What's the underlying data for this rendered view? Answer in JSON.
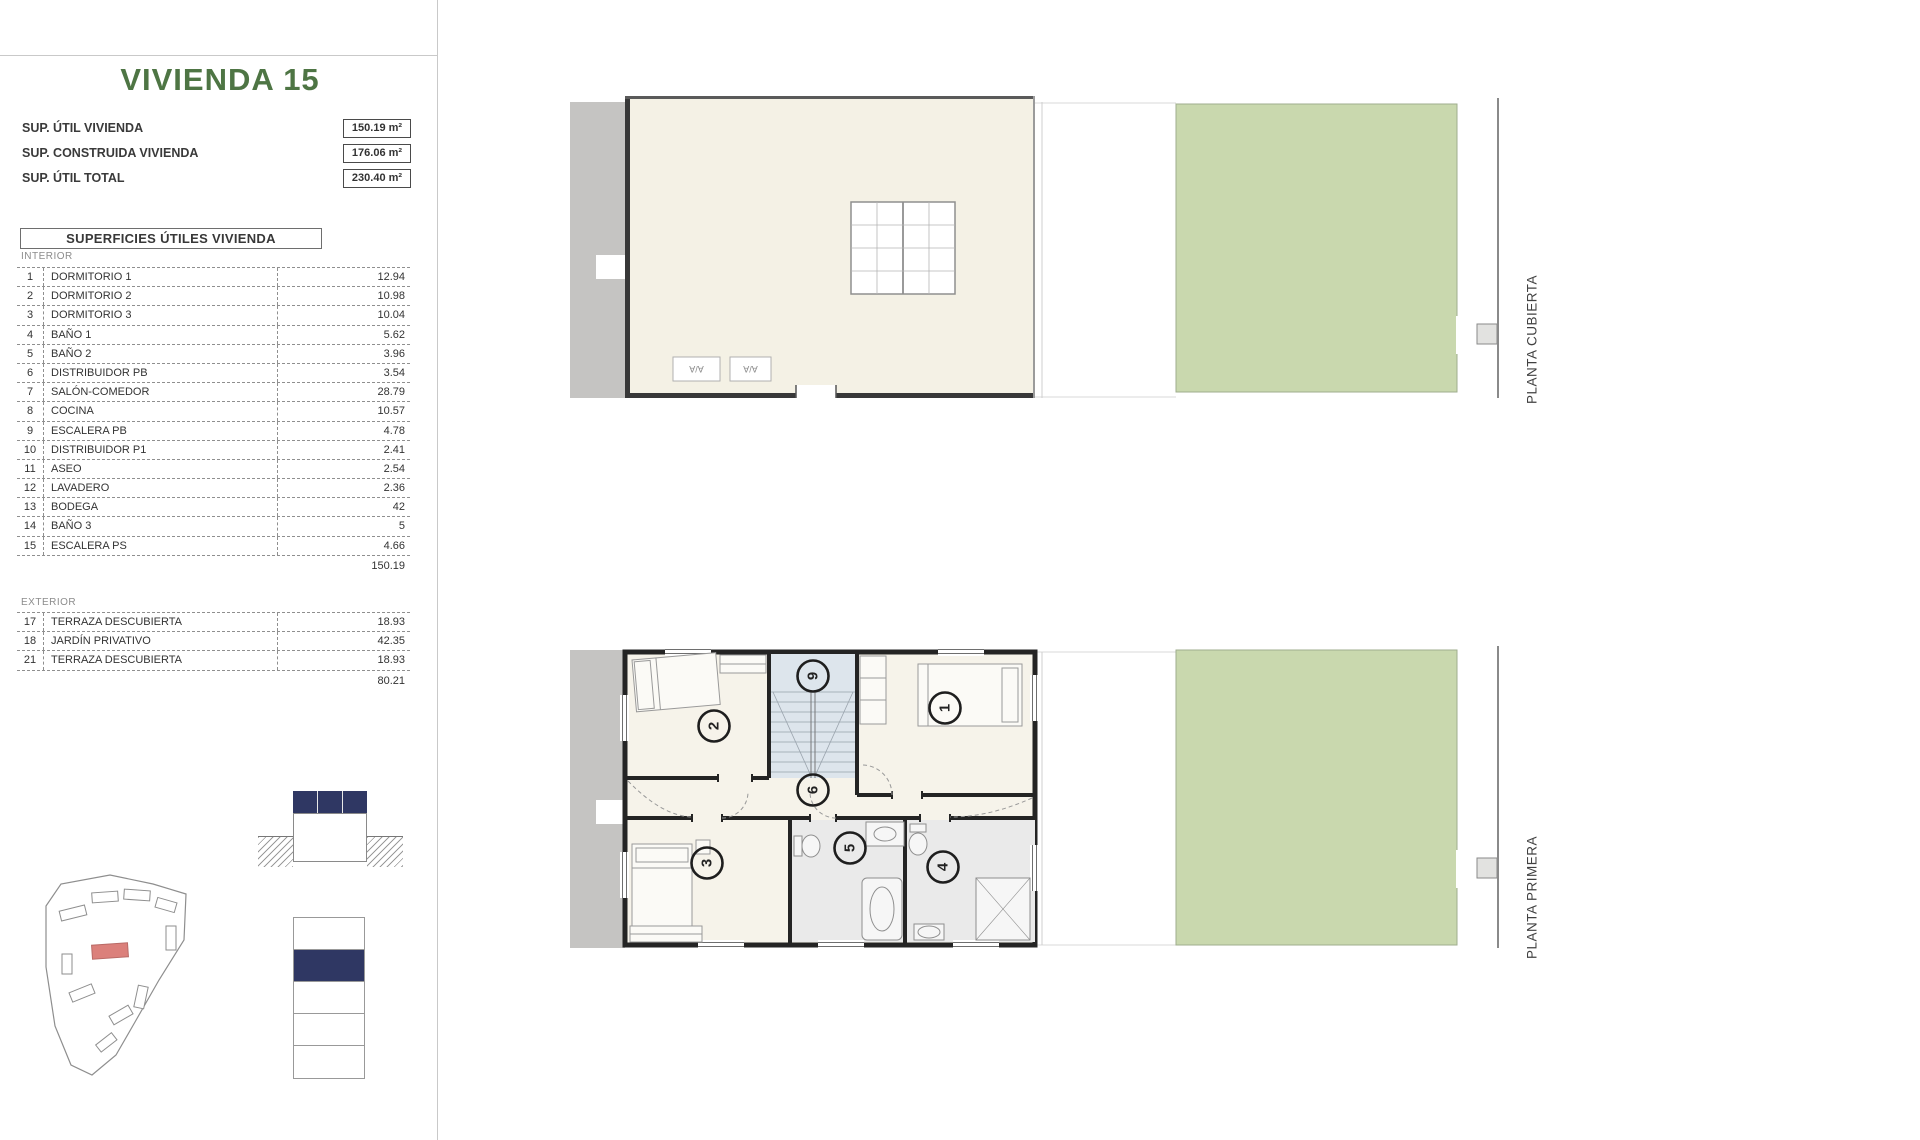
{
  "page": {
    "title": "VIVIENDA 15"
  },
  "summary": {
    "rows": [
      {
        "label": "SUP. ÚTIL VIVIENDA",
        "value": "150.19 m²"
      },
      {
        "label": "SUP. CONSTRUIDA VIVIENDA",
        "value": "176.06 m²"
      },
      {
        "label": "SUP. ÚTIL TOTAL",
        "value": "230.40 m²"
      }
    ]
  },
  "areas_table": {
    "title": "SUPERFICIES ÚTILES VIVIENDA",
    "interior": {
      "section_label": "INTERIOR",
      "rows": [
        {
          "num": "1",
          "name": "DORMITORIO 1",
          "value": "12.94"
        },
        {
          "num": "2",
          "name": "DORMITORIO 2",
          "value": "10.98"
        },
        {
          "num": "3",
          "name": "DORMITORIO 3",
          "value": "10.04"
        },
        {
          "num": "4",
          "name": "BAÑO 1",
          "value": "5.62"
        },
        {
          "num": "5",
          "name": "BAÑO 2",
          "value": "3.96"
        },
        {
          "num": "6",
          "name": "DISTRIBUIDOR PB",
          "value": "3.54"
        },
        {
          "num": "7",
          "name": "SALÓN-COMEDOR",
          "value": "28.79"
        },
        {
          "num": "8",
          "name": "COCINA",
          "value": "10.57"
        },
        {
          "num": "9",
          "name": "ESCALERA PB",
          "value": "4.78"
        },
        {
          "num": "10",
          "name": "DISTRIBUIDOR P1",
          "value": "2.41"
        },
        {
          "num": "11",
          "name": "ASEO",
          "value": "2.54"
        },
        {
          "num": "12",
          "name": "LAVADERO",
          "value": "2.36"
        },
        {
          "num": "13",
          "name": "BODEGA",
          "value": "42"
        },
        {
          "num": "14",
          "name": "BAÑO 3",
          "value": "5"
        },
        {
          "num": "15",
          "name": "ESCALERA PS",
          "value": "4.66"
        }
      ],
      "total": "150.19"
    },
    "exterior": {
      "section_label": "EXTERIOR",
      "rows": [
        {
          "num": "17",
          "name": "TERRAZA DESCUBIERTA",
          "value": "18.93"
        },
        {
          "num": "18",
          "name": "JARDÍN PRIVATIVO",
          "value": "42.35"
        },
        {
          "num": "21",
          "name": "TERRAZA DESCUBIERTA",
          "value": "18.93"
        }
      ],
      "total": "80.21"
    }
  },
  "plans": {
    "top": {
      "label": "PLANTA CUBIERTA",
      "ac": [
        "A/A",
        "A/A"
      ]
    },
    "bottom": {
      "label": "PLANTA PRIMERA",
      "markers": {
        "m1": "1",
        "m2": "2",
        "m3": "3",
        "m4": "4",
        "m5": "5",
        "m6": "6",
        "m9": "9"
      }
    }
  },
  "colors": {
    "accent_green": "#4e7544",
    "navy": "#2f3763",
    "garden_green": "#c9d8ae",
    "roof_cream": "#f4f1e5",
    "highlight_red": "#db807b"
  }
}
